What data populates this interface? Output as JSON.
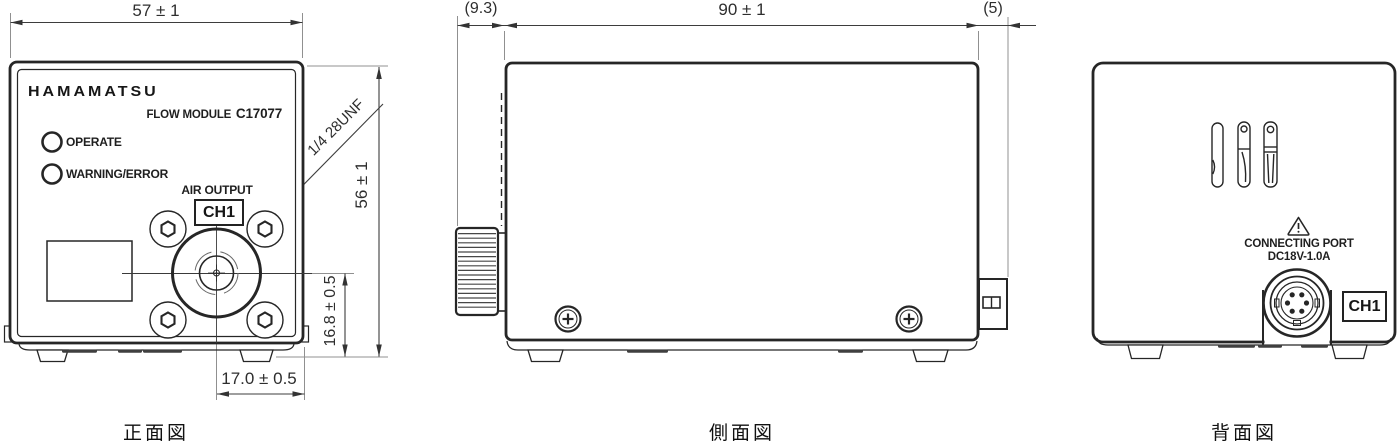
{
  "drawing": {
    "front": {
      "view_label": "正面図",
      "brand": "HAMAMATSU",
      "product_name": "FLOW MODULE",
      "model": "C17077",
      "led_operate": "OPERATE",
      "led_warning": "WARNING/ERROR",
      "air_output": "AIR OUTPUT",
      "channel": "CH1",
      "thread_callout": "1/4 28UNF",
      "dim_width": "57 ± 1",
      "dim_height": "56 ± 1",
      "dim_port_vertical": "16.8 ± 0.5",
      "dim_port_horizontal": "17.0 ± 0.5"
    },
    "side": {
      "view_label": "側面図",
      "dim_knob": "(9.3)",
      "dim_depth": "90 ± 1",
      "dim_rear": "(5)"
    },
    "back": {
      "view_label": "背面図",
      "connecting_port": "CONNECTING PORT",
      "power_rating": "DC18V-1.0A",
      "channel": "CH1"
    },
    "colors": {
      "outline": "#262626",
      "dimension": "#3d3d3d",
      "extension": "#909090"
    }
  }
}
